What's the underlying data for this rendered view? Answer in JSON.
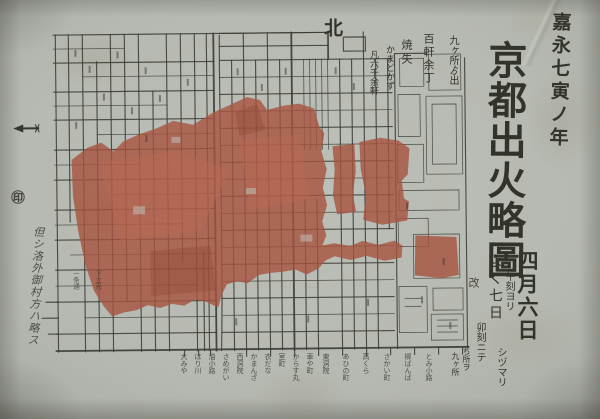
{
  "colors": {
    "paper": "#b6b9b1",
    "ink": "#3b3d36",
    "burn": "#a7533f",
    "burn_light": "#bb6a52",
    "burn_dark": "#8f4434"
  },
  "title": {
    "era": "嘉永七寅ノ年",
    "main": "京都出火略圖",
    "publisher_mark": "改"
  },
  "date_note": {
    "large": "四月六日",
    "from": "午刻ヨリ",
    "next_day": "よく七日",
    "calm": "シヅマリ",
    "hour": "卯刻ニテ",
    "tiny1": "ち所ヲ",
    "tiny2": "九ヶ所"
  },
  "stats_note": {
    "col1": "九ヶ所ゟ出",
    "col2": "百軒余丁",
    "col3": "焼失",
    "col4": "かまどかず",
    "col5": "凡六千余軒"
  },
  "compass": {
    "north": "北"
  },
  "left_note": {
    "seal": "㊞",
    "text": "但シ洛外御村方ハ略ス"
  },
  "map": {
    "inner_labels": [
      "一条通",
      "下立売"
    ],
    "street_labels": [
      "大みや",
      "ほり川",
      "油小路",
      "さめがい",
      "西洞院",
      "かまんざ",
      "衣だな",
      "室町",
      "からす丸",
      "車や町",
      "東洞院",
      "あひの町",
      "高くら",
      "さかい町",
      "柳ばんば",
      "とみ小路"
    ]
  }
}
